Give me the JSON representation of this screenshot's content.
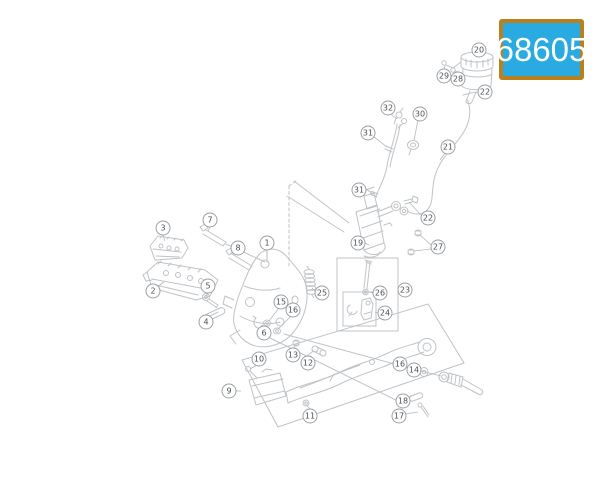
{
  "badge": {
    "text": "68605",
    "bg_color": "#29abe2",
    "border_color": "#b9811d",
    "text_color": "#ffffff"
  },
  "diagram": {
    "type": "exploded-parts-diagram",
    "description": "Motorcycle foot pegs and rear brake control exploded view",
    "line_color": "#bfc3c7",
    "callouts": [
      {
        "label": "1"
      },
      {
        "label": "2"
      },
      {
        "label": "3"
      },
      {
        "label": "4"
      },
      {
        "label": "5"
      },
      {
        "label": "6"
      },
      {
        "label": "7"
      },
      {
        "label": "8"
      },
      {
        "label": "9"
      },
      {
        "label": "10"
      },
      {
        "label": "11"
      },
      {
        "label": "12"
      },
      {
        "label": "13"
      },
      {
        "label": "14"
      },
      {
        "label": "15"
      },
      {
        "label": "16"
      },
      {
        "label": "16"
      },
      {
        "label": "17"
      },
      {
        "label": "18"
      },
      {
        "label": "19"
      },
      {
        "label": "20"
      },
      {
        "label": "21"
      },
      {
        "label": "22"
      },
      {
        "label": "22"
      },
      {
        "label": "23"
      },
      {
        "label": "24"
      },
      {
        "label": "25"
      },
      {
        "label": "26"
      },
      {
        "label": "27"
      },
      {
        "label": "28"
      },
      {
        "label": "29"
      },
      {
        "label": "30"
      },
      {
        "label": "31"
      },
      {
        "label": "31"
      },
      {
        "label": "32"
      }
    ]
  }
}
